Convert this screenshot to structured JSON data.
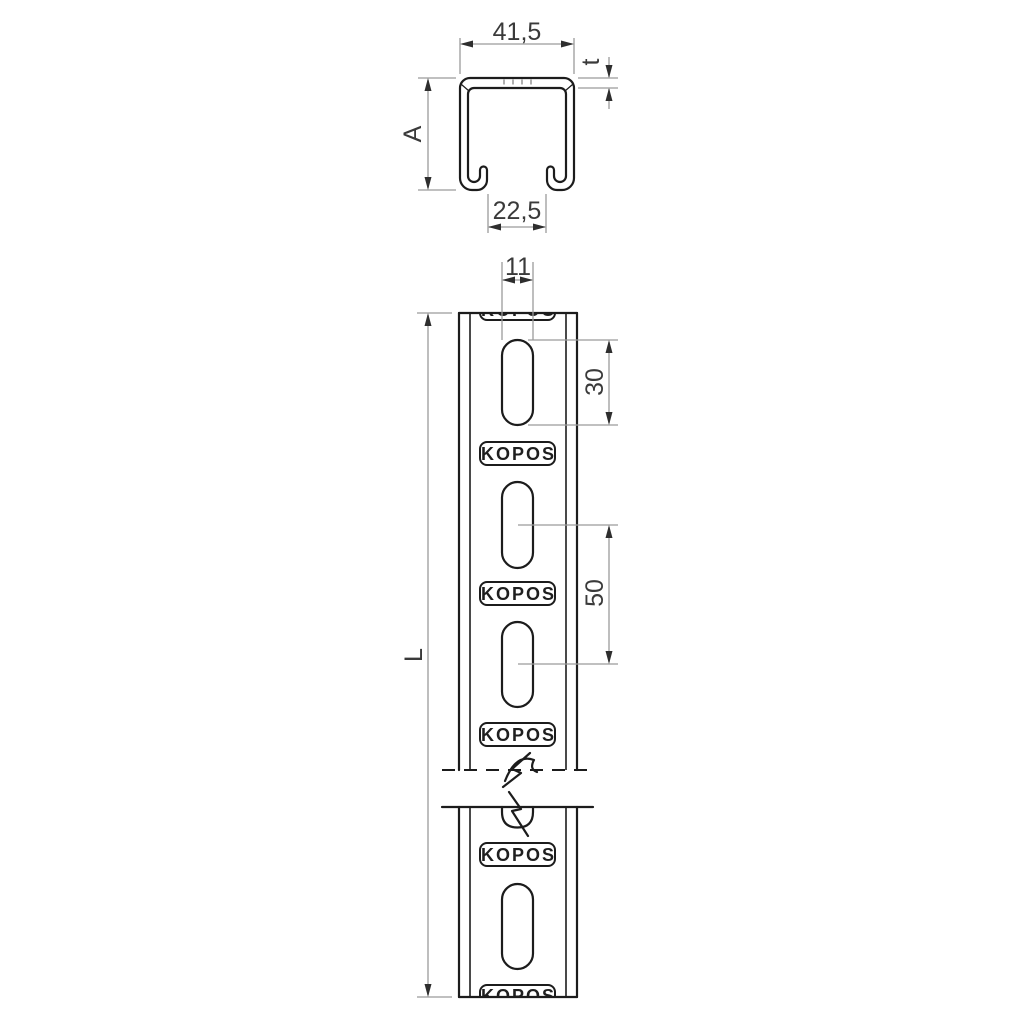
{
  "drawing": {
    "type": "technical-drawing",
    "brand": "KOPOS",
    "cross_section": {
      "width": "41,5",
      "thickness": "t",
      "height": "A",
      "opening": "22,5"
    },
    "front_view": {
      "slot_width": "11",
      "slot_length": "30",
      "slot_pitch": "50",
      "length": "L"
    },
    "colors": {
      "background": "#ffffff",
      "outline": "#1c1c1c",
      "dimension_line": "#9b9b9b",
      "dimension_text": "#3a3a3a"
    }
  }
}
